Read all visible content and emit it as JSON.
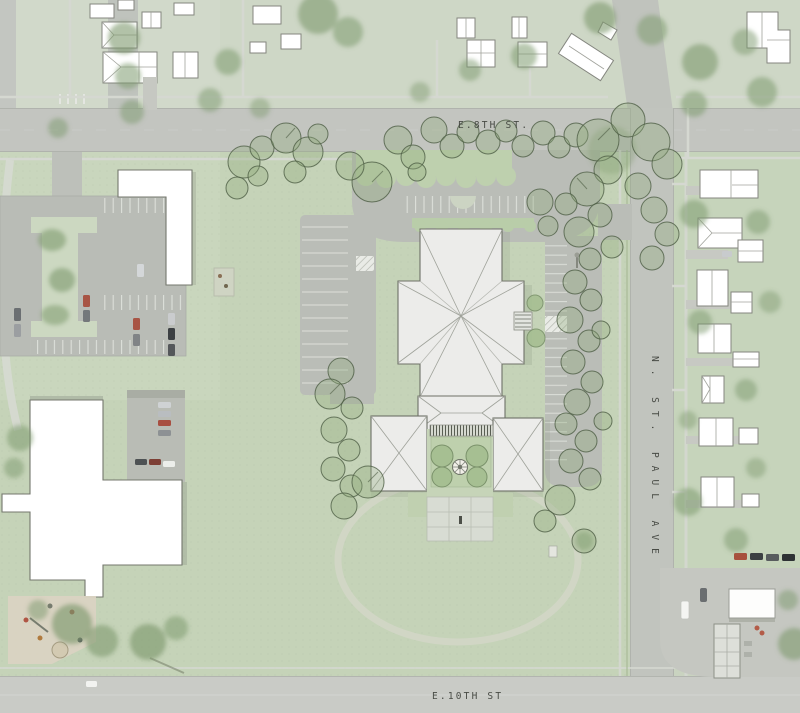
{
  "canvas": {
    "width": 800,
    "height": 713
  },
  "streets": {
    "e8th": {
      "label": "E.8TH ST.",
      "orientation": "horizontal"
    },
    "nstpaul": {
      "label": "N. ST. PAUL AVE",
      "orientation": "vertical"
    },
    "e10th": {
      "label": "E.10TH ST",
      "orientation": "horizontal"
    }
  },
  "colors": {
    "lawn": "#c9d3c0",
    "campus_lawn": "#c5d3b8",
    "road": "#c3c5c0",
    "pavement": "#babdb7",
    "building_white": "#ffffff",
    "roof_gray": "#ececea",
    "roof_line": "#9fa29a",
    "tree_fill": "#8fa97c",
    "tree_outline": "#4e5e45",
    "courtyard_green": "#bed0ad",
    "plaza": "#d8dcd3",
    "sand": "#dad3c2"
  }
}
